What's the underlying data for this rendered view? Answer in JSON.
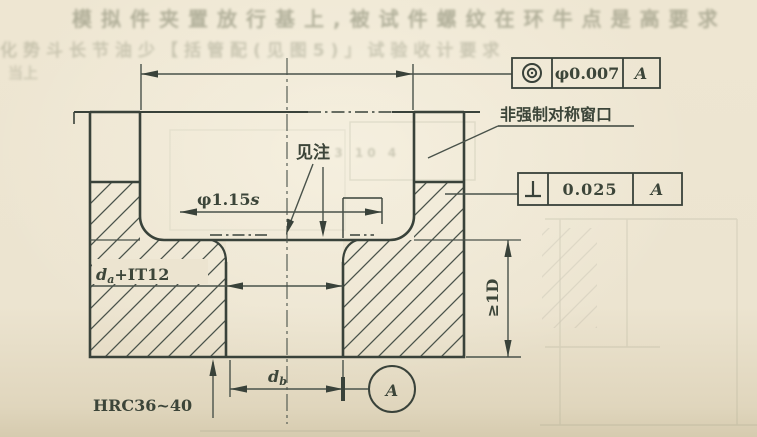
{
  "page": {
    "background_color": "#ece4d0",
    "ink_color": "#3c4539",
    "faint_ink_color": "#8a8f78",
    "description": "Scanned Chinese technical drawing of a gauge/fixture cross-section"
  },
  "ghost_text": {
    "top_line1": "模拟件夹置放行基上,被试件螺纹在环牛点是高要求",
    "top_line2": "化势斗长节油少【括管配(见图5)」试验收计要求",
    "left_margin": "当上",
    "cavity_mark": "13 10 4",
    "right_margin_top": "对齐平装"
  },
  "frames": {
    "concentricity": {
      "symbol_name": "concentricity-symbol",
      "tolerance": "φ0.007",
      "datum": "A"
    },
    "perpendicularity": {
      "symbol_name": "perpendicularity-symbol",
      "tolerance": "0.025",
      "datum": "A"
    }
  },
  "labels": {
    "window_note": "非强制对称窗口",
    "see_note": "见注",
    "bore_dim_main": "φ1.15",
    "bore_dim_var": "s",
    "da_main": "d",
    "da_sub": "a",
    "da_rest": "+IT12",
    "db_main": "d",
    "db_sub": "b",
    "hardness": "HRC36~40",
    "depth": "≥1D",
    "datum_letter": "A"
  }
}
